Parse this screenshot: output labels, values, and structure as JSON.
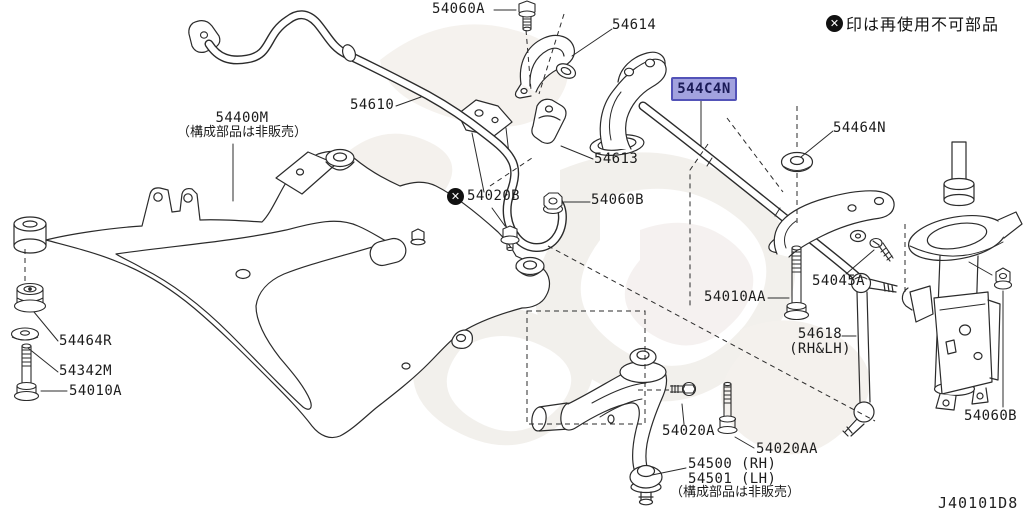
{
  "diagram": {
    "code": "J40101D8",
    "note": {
      "icon_glyph": "✕",
      "text": "印は再使用不可部品"
    },
    "highlight_colors": {
      "fill": "#a2a2de",
      "border": "#5353b8",
      "text": "#1b1b57"
    }
  },
  "parts": {
    "p54060A": "54060A",
    "p54614": "54614",
    "p54610": "54610",
    "p54400M": "54400M",
    "p54400M_note": "（構成部品は非販売）",
    "p544C4N": "544C4N",
    "p54464N": "54464N",
    "p54613": "54613",
    "p54020B": "54020B",
    "p54060B": "54060B",
    "p54010AA": "54010AA",
    "p54045A": "54045A",
    "p54618": "54618",
    "p54618_side": "(RH&LH)",
    "p54464R": "54464R",
    "p54342M": "54342M",
    "p54010A": "54010A",
    "p54020A": "54020A",
    "p54020AA": "54020AA",
    "p54500": "54500 (RH)",
    "p54501": "54501 (LH)",
    "p54500_note": "（構成部品は非販売）",
    "p54060B_strut": "54060B"
  }
}
